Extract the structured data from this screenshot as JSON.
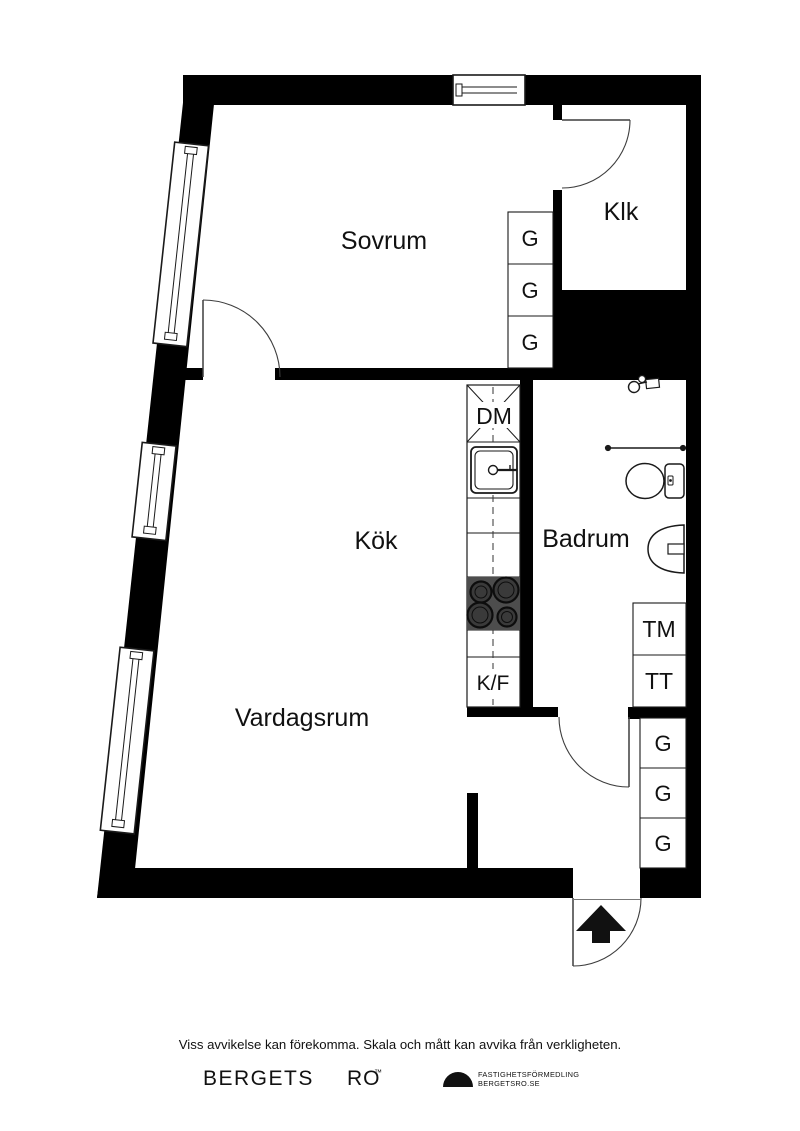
{
  "rooms": {
    "bedroom": "Sovrum",
    "closet": "Klk",
    "kitchen": "Kök",
    "bathroom": "Badrum",
    "living_room": "Vardagsrum"
  },
  "labels": {
    "dishwasher": "DM",
    "fridge_freezer": "K/F",
    "washing_machine": "TM",
    "tumble_dryer": "TT",
    "wardrobe": "G"
  },
  "footer": {
    "disclaimer": "Viss avvikelse kan förekomma. Skala och mått kan avvika från verkligheten."
  },
  "branding": {
    "brand_left": "BERGETS",
    "brand_right": "RO",
    "trademark": "™",
    "agency_line1": "FASTIGHETSFÖRMEDLING",
    "agency_line2": "BERGETSRO.SE"
  },
  "colors": {
    "wall": "#000000",
    "stove": "#4d4d4d",
    "burner": "#3a3a3a"
  }
}
